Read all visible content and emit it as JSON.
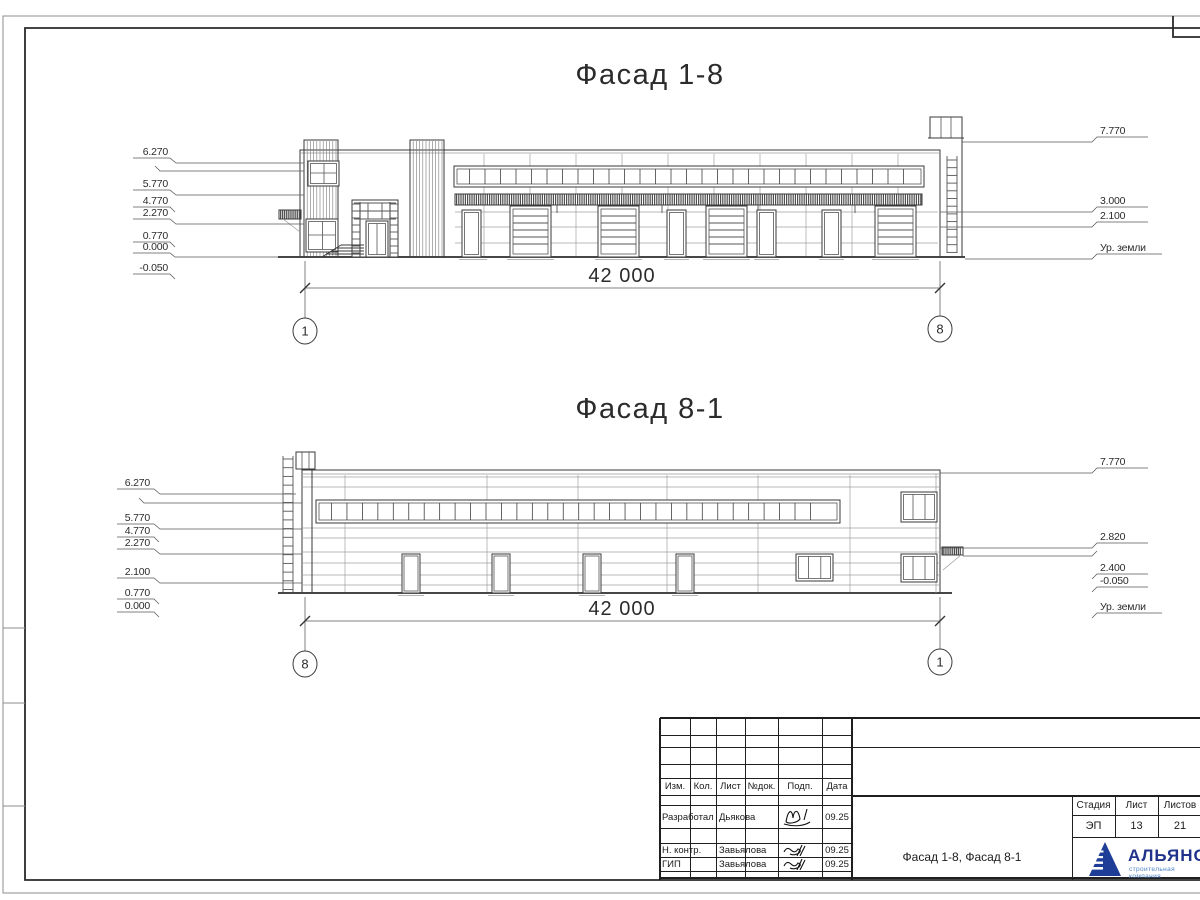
{
  "drawing": {
    "facade_top": {
      "title": "Фасад 1-8",
      "dim": "42 000",
      "axis_left": "1",
      "axis_right": "8",
      "marks_left": {
        "m6270": "6.270",
        "m5770": "5.770",
        "m4770": "4.770",
        "m2270": "2.270",
        "m0770": "0.770",
        "m0000": "0.000",
        "mneg": "-0.050"
      },
      "marks_right": {
        "m7770": "7.770",
        "m3000": "3.000",
        "m2100": "2.100",
        "ground": "Ур. земли"
      }
    },
    "facade_bottom": {
      "title": "Фасад 8-1",
      "dim": "42 000",
      "axis_left": "8",
      "axis_right": "1",
      "marks_left": {
        "m6270": "6.270",
        "m5770": "5.770",
        "m4770": "4.770",
        "m2270": "2.270",
        "m2100": "2.100",
        "m0770": "0.770",
        "m0000": "0.000"
      },
      "marks_right": {
        "m7770": "7.770",
        "m2820": "2.820",
        "m2400": "2.400",
        "mneg": "-0.050",
        "ground": "Ур. земли"
      }
    },
    "title_block": {
      "cols": {
        "izm": "Изм.",
        "kol": "Кол.",
        "list": "Лист",
        "ndok": "№док.",
        "podp": "Подп.",
        "data": "Дата"
      },
      "rows": [
        {
          "role": "Разработал",
          "name": "Дьякова",
          "date": "09.25"
        },
        {
          "role": "Н. контр.",
          "name": "Завьялова",
          "date": "09.25"
        },
        {
          "role": "ГИП",
          "name": "Завьялова",
          "date": "09.25"
        }
      ],
      "doc_title": "Фасад 1-8, Фасад 8-1",
      "stage_col": "Стадия",
      "sheet_col": "Лист",
      "sheets_col": "Листов",
      "stage": "ЭП",
      "sheet_num": "13",
      "sheets_total": "21",
      "logo": {
        "name": "АЛЬЯНС",
        "tagline": "строительная компания"
      }
    }
  }
}
